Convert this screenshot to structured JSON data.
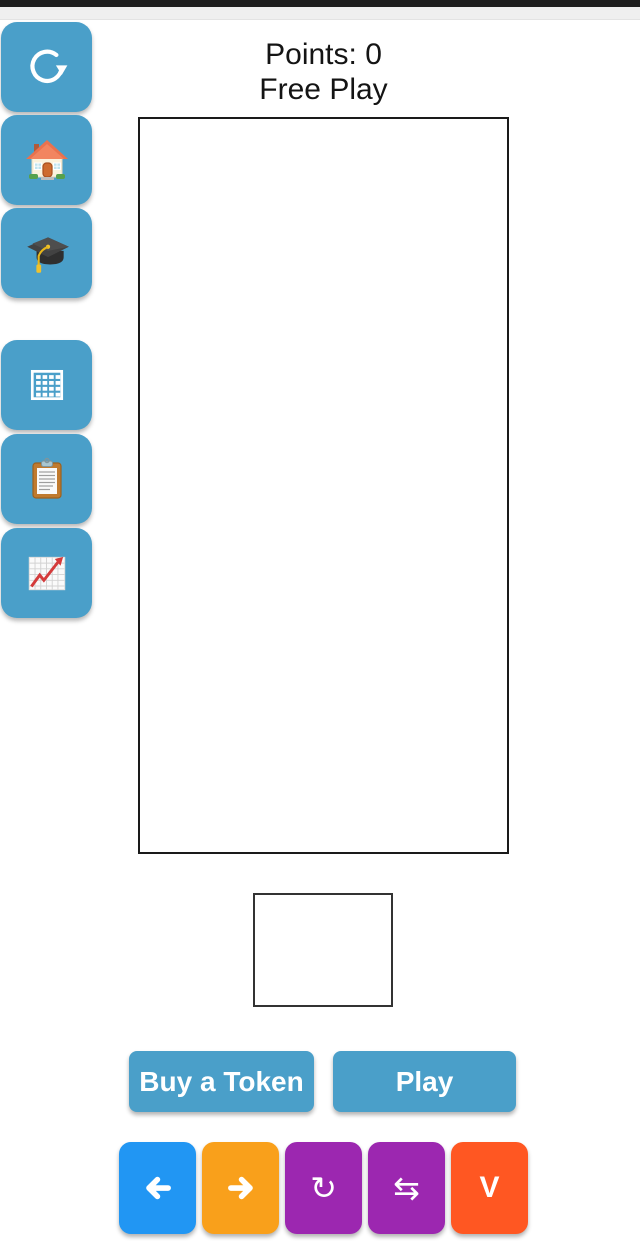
{
  "window": {
    "width": 640,
    "height": 1241
  },
  "status_bar": {
    "color": "#1E1E1E"
  },
  "top_bar": {
    "color": "#EFEFEF"
  },
  "header": {
    "points_label": "Points:",
    "points_value": "0",
    "mode": "Free Play"
  },
  "sidebar": {
    "color": "#4A9FC9",
    "items": [
      {
        "id": "refresh",
        "icon": "refresh-icon"
      },
      {
        "id": "home",
        "icon": "house-icon"
      },
      {
        "id": "learn",
        "icon": "graduation-cap-icon"
      },
      {
        "id": "grid",
        "icon": "grid-icon"
      },
      {
        "id": "scores",
        "icon": "clipboard-icon"
      },
      {
        "id": "stats",
        "icon": "chart-up-icon"
      }
    ]
  },
  "board": {
    "background": "#FFFFFF",
    "border_color": "#1A1A1A"
  },
  "preview": {
    "background": "#FFFFFF",
    "border_color": "#333333"
  },
  "actions": {
    "buy_token": {
      "label": "Buy a Token",
      "color": "#4A9FC9"
    },
    "play": {
      "label": "Play",
      "color": "#4A9FC9"
    }
  },
  "controls": {
    "items": [
      {
        "id": "move-left",
        "icon": "arrow-left-icon",
        "color": "#2196F3"
      },
      {
        "id": "move-right",
        "icon": "arrow-right-icon",
        "color": "#F9A01B"
      },
      {
        "id": "rotate",
        "icon": "rotate-icon",
        "glyph": "↻",
        "color": "#9C27B0"
      },
      {
        "id": "swap",
        "icon": "swap-icon",
        "glyph": "⇆",
        "color": "#9C27B0"
      },
      {
        "id": "drop",
        "icon": "drop-icon",
        "glyph": "V",
        "color": "#FF5722"
      }
    ]
  }
}
